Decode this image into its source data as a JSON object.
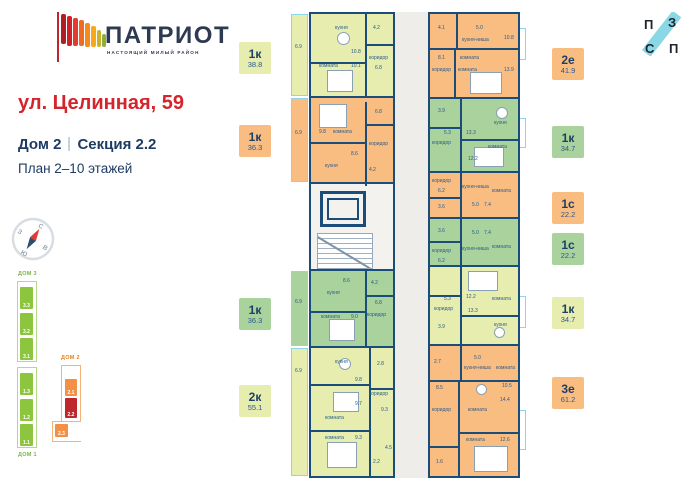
{
  "header": {
    "logo_title": "ПАТРИОТ",
    "logo_subtitle": "НАСТОЯЩИЙ МИЛЫЙ РАЙОН",
    "address": "ул. Целинная, 59",
    "house": "Дом 2",
    "section": "Секция 2.2",
    "floors": "План 2–10 этажей"
  },
  "pzsp": {
    "letters": [
      "П",
      "З",
      "С",
      "П"
    ]
  },
  "compass": {
    "n": "С",
    "e": "В",
    "s": "Ю",
    "w": "З"
  },
  "minimap": {
    "dom3": {
      "label": "ДОМ 3",
      "sections": [
        "3.3",
        "3.2",
        "3.1"
      ]
    },
    "dom1": {
      "label": "ДОМ 1",
      "sections": [
        "1.3",
        "1.2",
        "1.1"
      ]
    },
    "dom2": {
      "label": "ДОМ 2",
      "sections": [
        "2.1",
        "2.2",
        "2.3"
      ],
      "active": "2.2"
    }
  },
  "badges_left": [
    {
      "t": "1к",
      "a": "38.8"
    },
    {
      "t": "1к",
      "a": "36.3"
    },
    {
      "t": "1к",
      "a": "36.3"
    },
    {
      "t": "2к",
      "a": "55.1"
    }
  ],
  "badges_right": [
    {
      "t": "2е",
      "a": "41.9"
    },
    {
      "t": "1к",
      "a": "34.7"
    },
    {
      "t": "1с",
      "a": "22.2"
    },
    {
      "t": "1с",
      "a": "22.2"
    },
    {
      "t": "1к",
      "a": "34.7"
    },
    {
      "t": "3е",
      "a": "61.2"
    }
  ],
  "plan": {
    "apartments": {
      "a1": {
        "type": "1к",
        "area": "38.8",
        "rooms": [
          "6.9",
          "кухня",
          "10.8",
          "4.2",
          "комната",
          "10.1",
          "коридор",
          "6.8"
        ]
      },
      "a2": {
        "type": "1к",
        "area": "36.3",
        "rooms": [
          "6.9",
          "9.8",
          "комната",
          "кухня",
          "8.6",
          "коридор",
          "6.8",
          "4.2"
        ]
      },
      "a3": {
        "type": "1к",
        "area": "36.3",
        "rooms": [
          "6.9",
          "кухня",
          "8.6",
          "комната",
          "9.0",
          "коридор",
          "6.8",
          "4.2"
        ]
      },
      "a4": {
        "type": "2к",
        "area": "55.1",
        "rooms": [
          "6.9",
          "кухня",
          "2.8",
          "9.8",
          "коридор",
          "9.7",
          "комната",
          "9.3",
          "комната",
          "9.3",
          "2.2",
          "4.5"
        ]
      },
      "b1": {
        "type": "2е",
        "area": "41.9",
        "rooms": [
          "4.1",
          "кухня-ниша",
          "5.0",
          "10.8",
          "коридор",
          "8.1",
          "комната",
          "комната",
          "13.9"
        ]
      },
      "b2": {
        "type": "1к",
        "area": "34.7",
        "rooms": [
          "3.9",
          "коридор",
          "5.3",
          "кухня",
          "13.3",
          "комната",
          "12.2"
        ]
      },
      "b3": {
        "type": "1с",
        "area": "22.2",
        "rooms": [
          "коридор",
          "6.2",
          "3.6",
          "кухня-ниша",
          "5.0",
          "7.4",
          "комната"
        ]
      },
      "b4": {
        "type": "1с",
        "area": "22.2",
        "rooms": [
          "коридор",
          "6.2",
          "3.6",
          "кухня-ниша",
          "5.0",
          "7.4",
          "комната"
        ]
      },
      "b5": {
        "type": "1к",
        "area": "34.7",
        "rooms": [
          "коридор",
          "5.3",
          "12.2",
          "13.3",
          "комната",
          "кухня",
          "3.9"
        ]
      },
      "b6": {
        "type": "3е",
        "area": "61.2",
        "rooms": [
          "2.7",
          "кухня-ниша",
          "5.0",
          "комната",
          "10.5",
          "8.5",
          "14.4",
          "коридор",
          "комната",
          "комната",
          "12.6",
          "1.6"
        ]
      }
    }
  },
  "colors": {
    "navy": "#1b4d7a",
    "red": "#d5242b",
    "green": "#a9d29c",
    "yellow_green": "#e6edae",
    "orange": "#f9bd81",
    "active_red": "#bf272c",
    "cyan": "#8fd4ee",
    "corridor_gray": "#efedea"
  }
}
